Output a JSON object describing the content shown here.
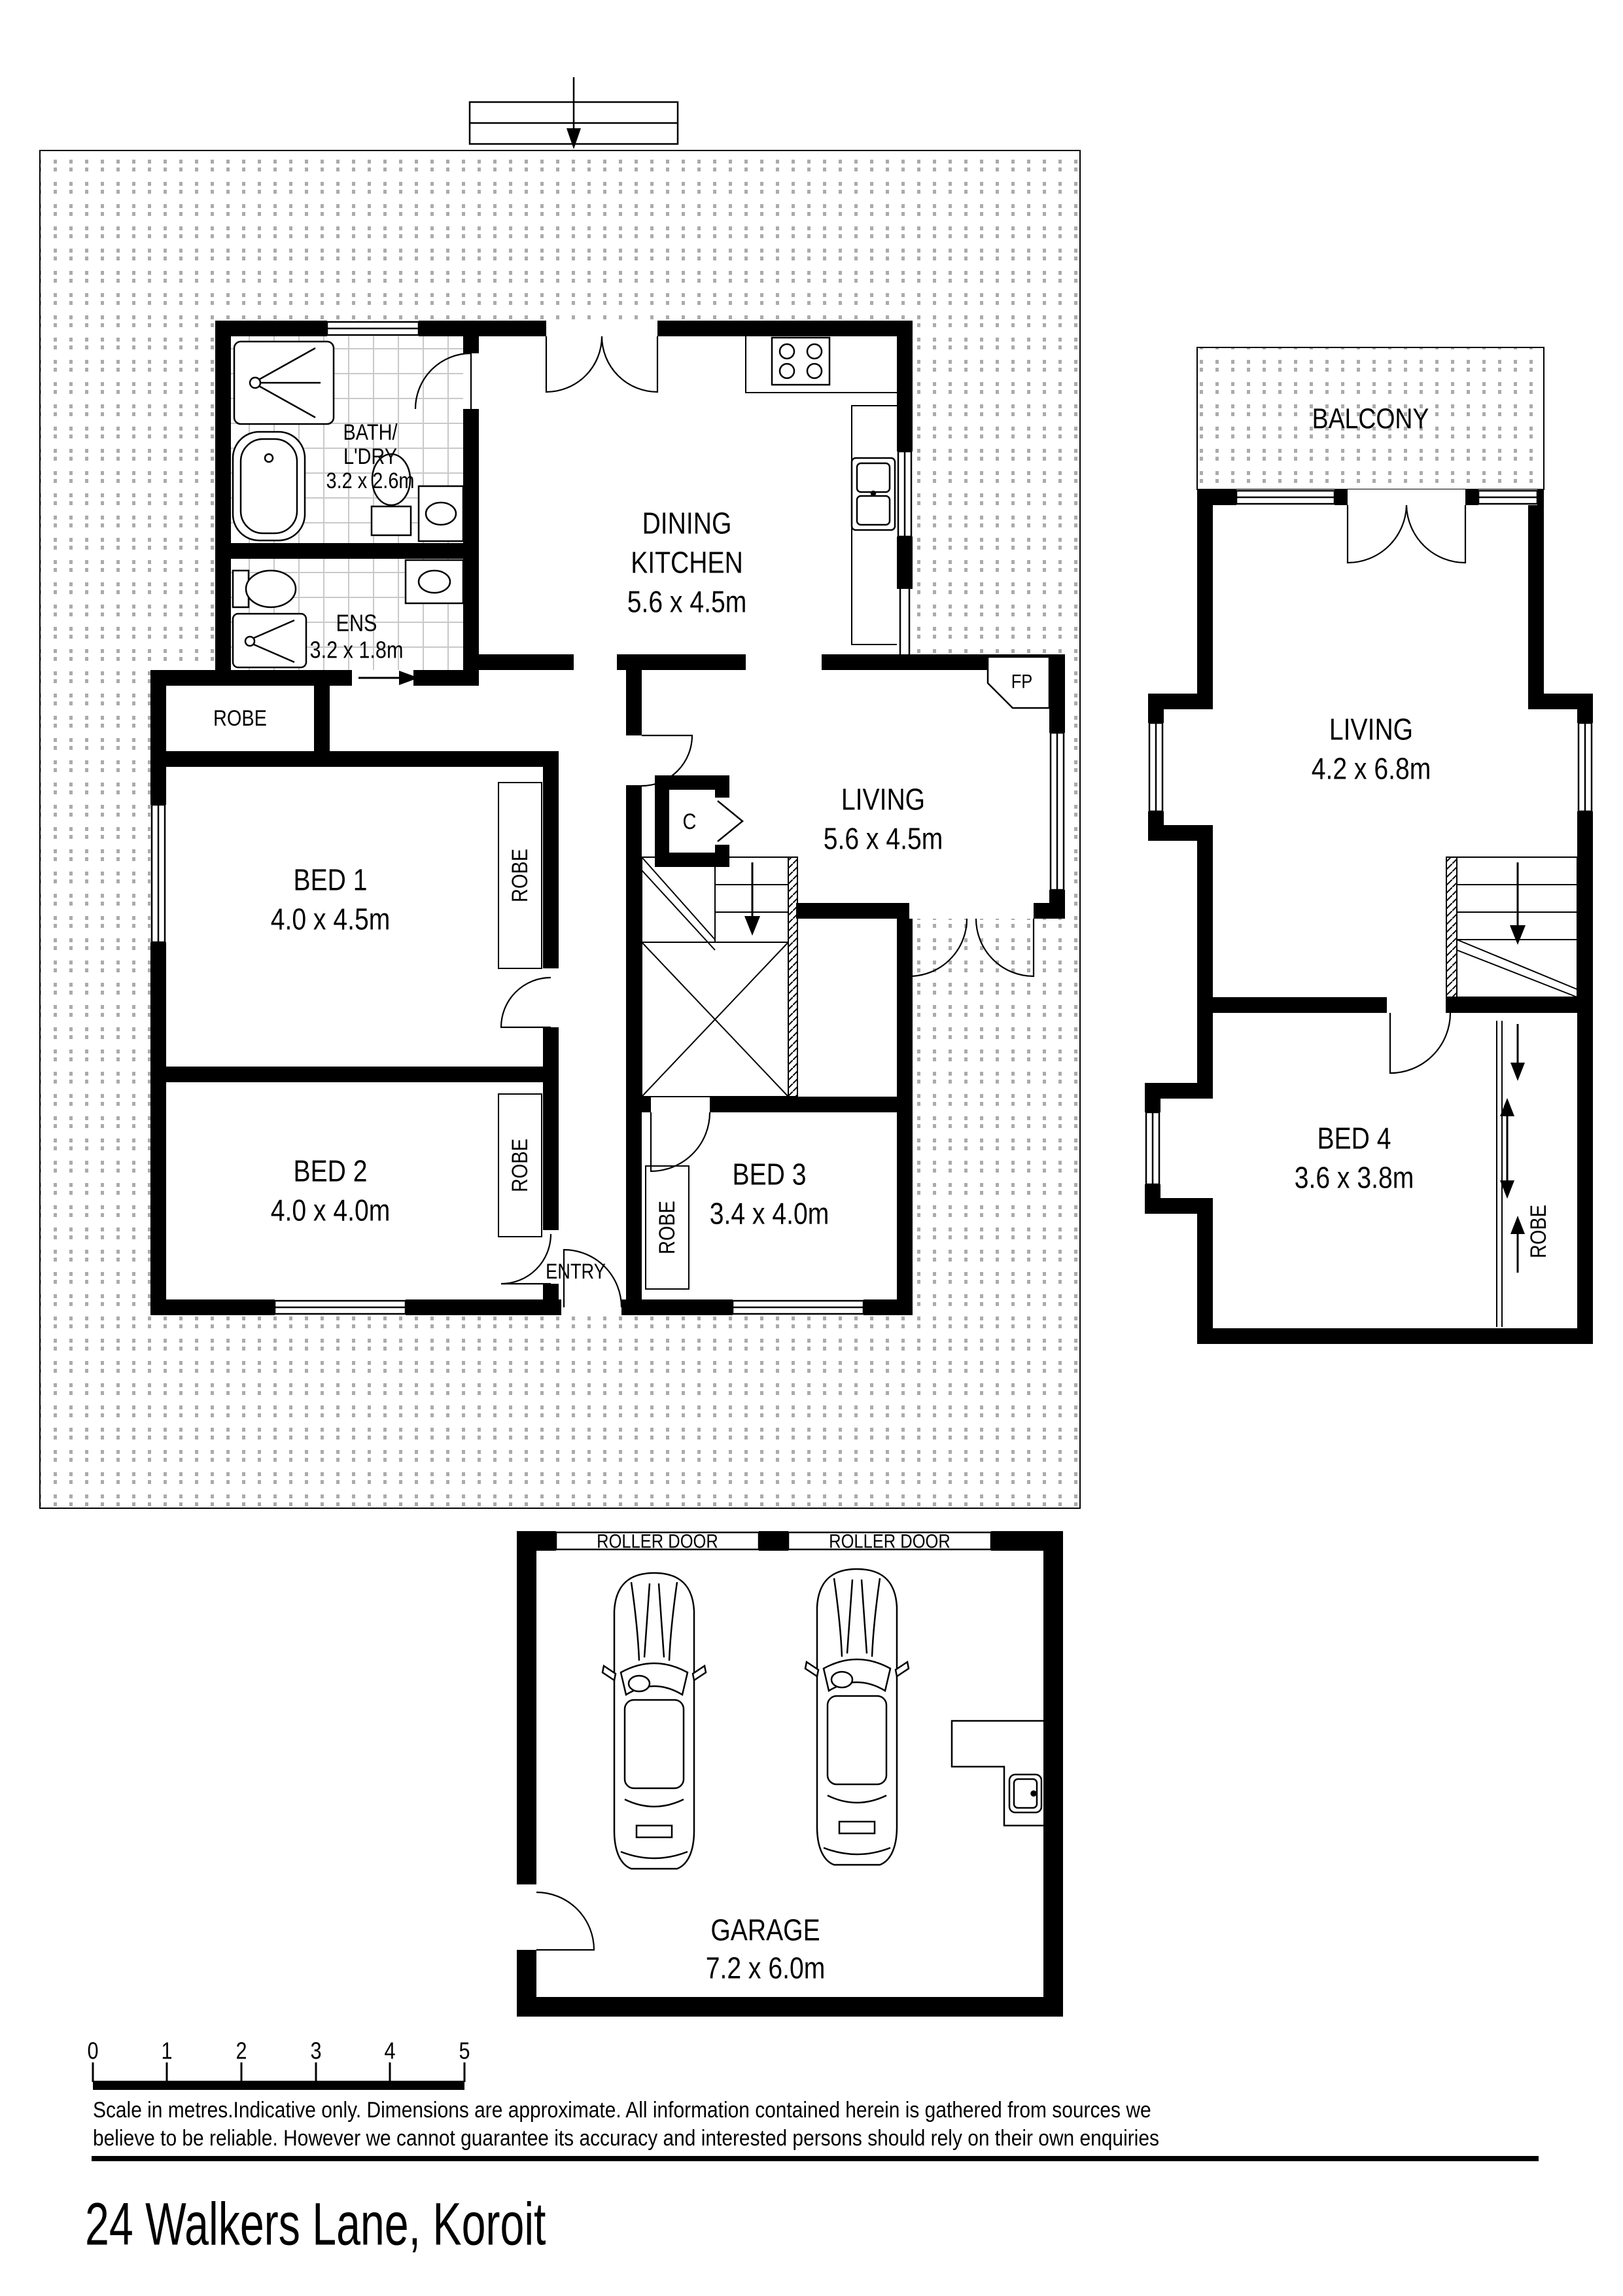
{
  "title": "24 Walkers Lane, Koroit",
  "labels": {
    "robe": "ROBE",
    "entry": "ENTRY",
    "fireplace": "FP",
    "cupboard": "C"
  },
  "ground_floor": {
    "bath": {
      "line1": "BATH/",
      "line2": "L'DRY",
      "dims": "3.2 x 2.6m"
    },
    "ensuite": {
      "name": "ENS",
      "dims": "3.2 x 1.8m"
    },
    "dining_kitchen": {
      "line1": "DINING",
      "line2": "KITCHEN",
      "dims": "5.6 x 4.5m"
    },
    "living": {
      "name": "LIVING",
      "dims": "5.6 x 4.5m"
    },
    "bed1": {
      "name": "BED 1",
      "dims": "4.0 x 4.5m"
    },
    "bed2": {
      "name": "BED 2",
      "dims": "4.0 x 4.0m"
    },
    "bed3": {
      "name": "BED 3",
      "dims": "3.4 x 4.0m"
    }
  },
  "upper_floor": {
    "balcony": "BALCONY",
    "living": {
      "name": "LIVING",
      "dims": "4.2 x 6.8m"
    },
    "bed4": {
      "name": "BED 4",
      "dims": "3.6 x 3.8m"
    }
  },
  "garage": {
    "name": "GARAGE",
    "dims": "7.2 x 6.0m",
    "roller_door": "ROLLER DOOR"
  },
  "scale_bar": {
    "ticks": [
      "0",
      "1",
      "2",
      "3",
      "4",
      "5"
    ]
  },
  "disclaimer": {
    "line1": "Scale in metres.Indicative only. Dimensions are approximate. All information contained herein is gathered from sources we",
    "line2": "believe to be reliable. However we cannot guarantee its accuracy and interested persons should rely on their own enquiries"
  }
}
